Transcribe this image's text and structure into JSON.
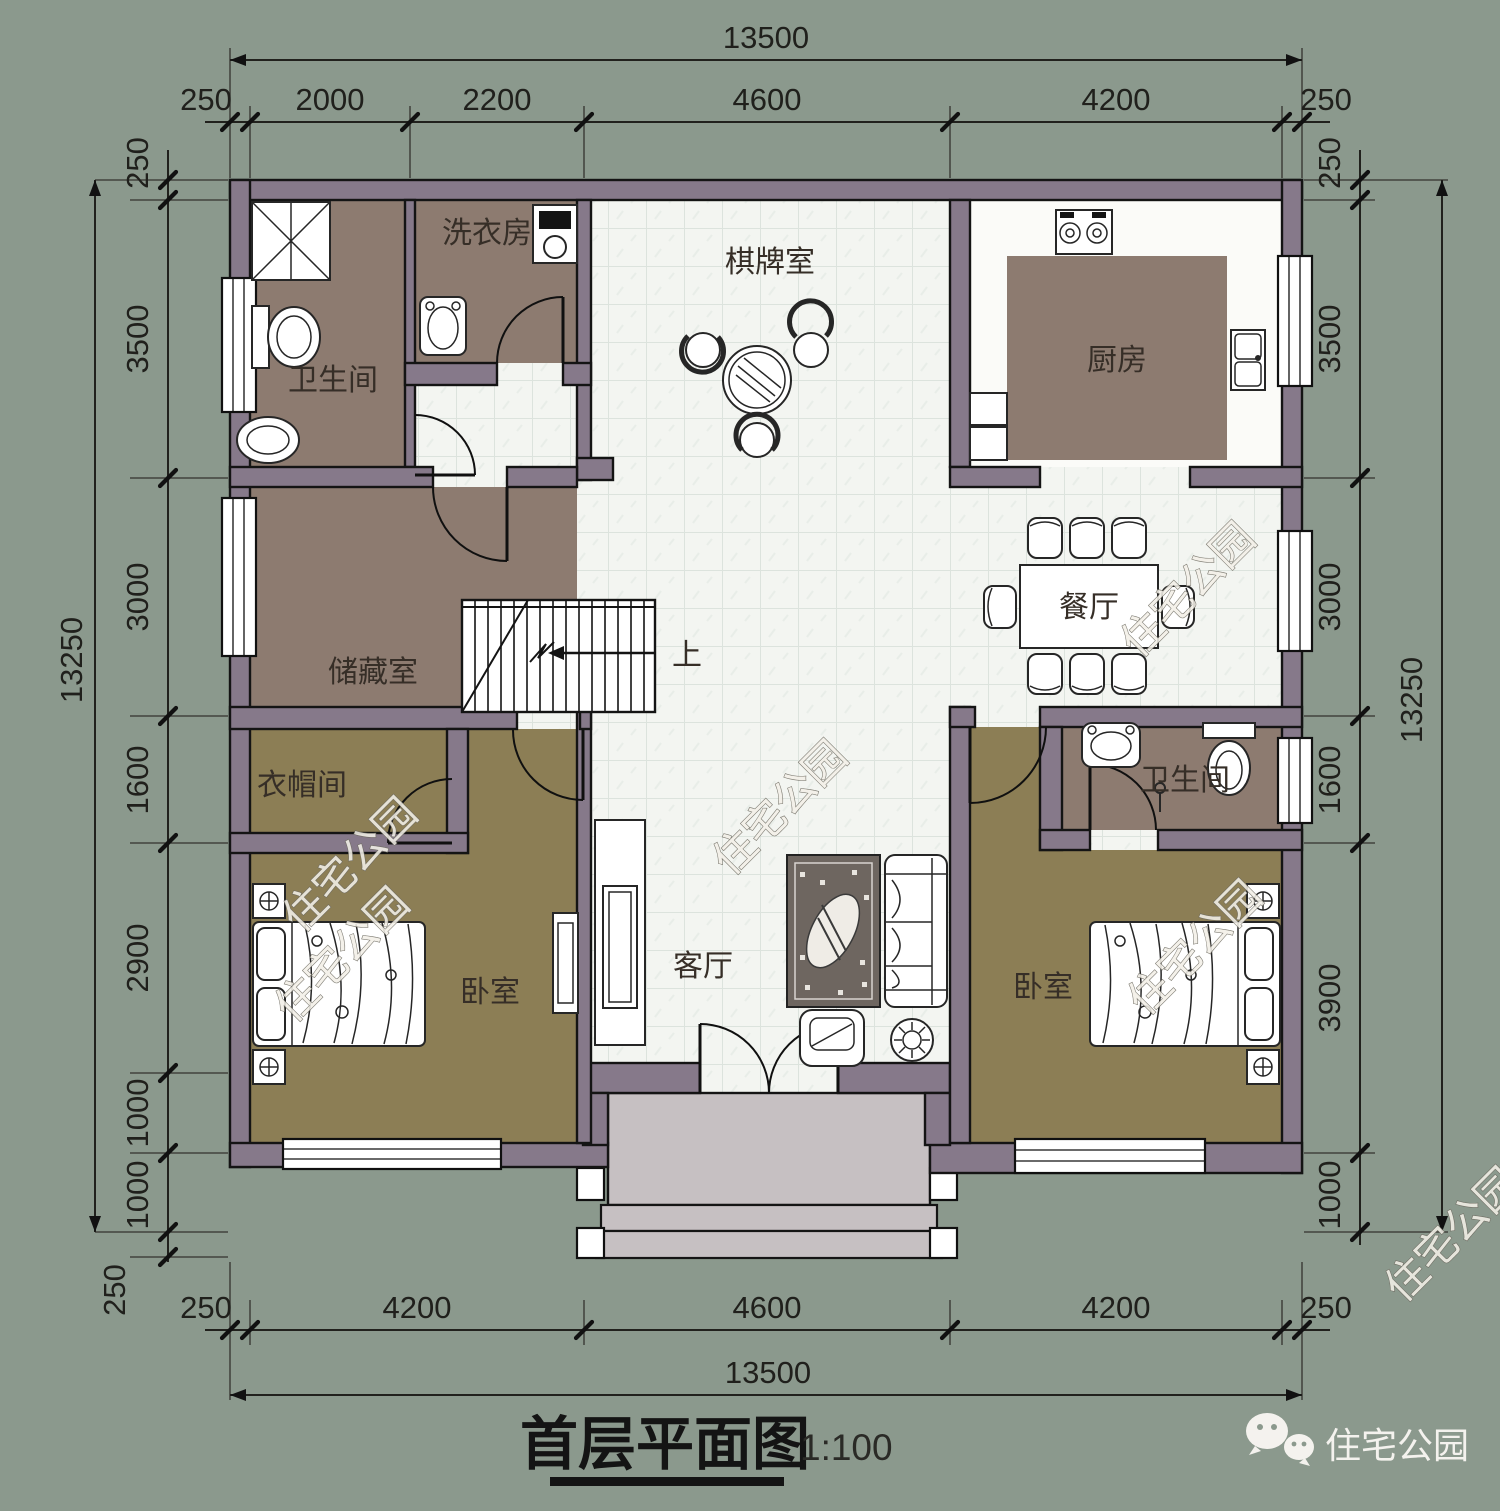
{
  "meta": {
    "title": "首层平面图",
    "scale_label": "1:100"
  },
  "branding": {
    "watermark": "住宅公园",
    "wechat_label": "住宅公园"
  },
  "rooms": {
    "bathroom_top": "卫生间",
    "laundry": "洗衣房",
    "game_room": "棋牌室",
    "kitchen": "厨房",
    "storage": "储藏室",
    "dining": "餐厅",
    "cloakroom": "衣帽间",
    "bathroom_right": "卫生间",
    "bedroom_left": "卧室",
    "living": "客厅",
    "bedroom_right": "卧室",
    "stairs_up": "上"
  },
  "dimensions": {
    "top": {
      "overall": "13500",
      "segments": [
        "250",
        "2000",
        "2200",
        "4600",
        "4200",
        "250"
      ]
    },
    "bottom": {
      "overall": "13500",
      "segments": [
        "250",
        "4200",
        "4600",
        "4200",
        "250"
      ]
    },
    "left": {
      "overall": "13250",
      "segments": [
        "250",
        "3500",
        "3000",
        "1600",
        "2900",
        "1000",
        "1000",
        "250"
      ]
    },
    "right": {
      "overall": "13250",
      "segments": [
        "250",
        "3500",
        "3000",
        "1600",
        "3900",
        "1000"
      ]
    }
  },
  "colors": {
    "background": "#8b998d",
    "wall": "#86798a",
    "brown_floor": "#8d7b70",
    "olive_floor": "#8c7e55",
    "tile_floor": "#f3f5f1",
    "porch": "#c6c0c2",
    "rug": "#6e6660"
  }
}
